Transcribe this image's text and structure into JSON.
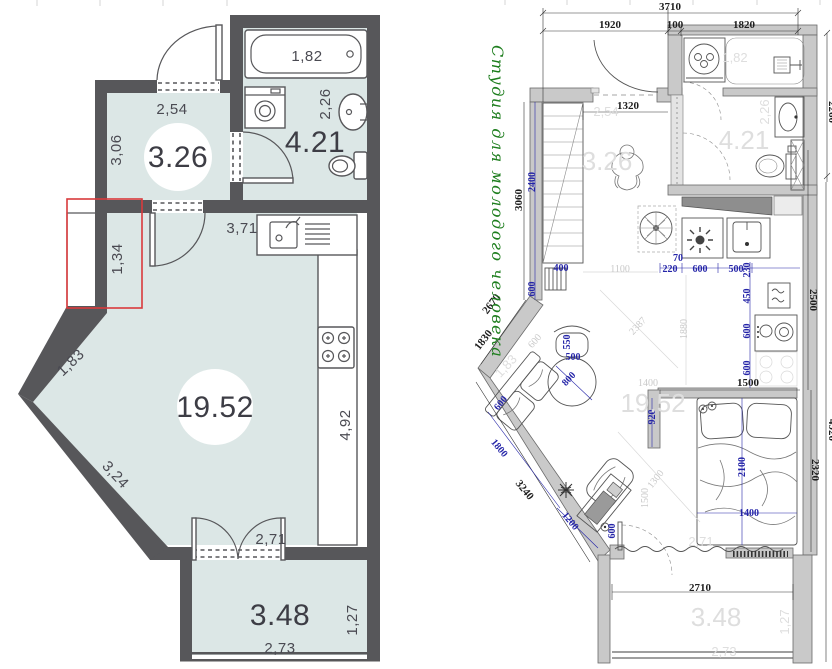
{
  "palette": {
    "wall_dark": "#57575a",
    "floor": "#dce7e6",
    "red_highlight": "#d93a3c",
    "cad_wall_gray": "#c9c9c9",
    "dim_blue": "#2525a8",
    "dim_black": "#1f1f1f",
    "faded_gray": "#d9d9d9",
    "title_green": "#1e7e1e"
  },
  "left_plan": {
    "labels": [
      {
        "t": "1,82",
        "x": 307,
        "y": 61
      },
      {
        "t": "2,26",
        "x": 330,
        "y": 104,
        "r": -90
      },
      {
        "t": "4.21",
        "x": 315,
        "y": 152,
        "c": "area"
      },
      {
        "t": "2,54",
        "x": 172,
        "y": 114
      },
      {
        "t": "3,06",
        "x": 121,
        "y": 150,
        "r": -90
      },
      {
        "t": "3.26",
        "x": 178,
        "y": 167,
        "c": "area",
        "badge": {
          "cx": 178,
          "cy": 157,
          "rad": 34
        }
      },
      {
        "t": "1,34",
        "x": 122,
        "y": 259,
        "r": -90
      },
      {
        "t": "3,71",
        "x": 242,
        "y": 233
      },
      {
        "t": "1,83",
        "x": 74,
        "y": 366,
        "r": -44
      },
      {
        "t": "19.52",
        "x": 215,
        "y": 417,
        "c": "area",
        "badge": {
          "cx": 215,
          "cy": 407,
          "rad": 38
        }
      },
      {
        "t": "4,92",
        "x": 350,
        "y": 425,
        "r": -90
      },
      {
        "t": "3,24",
        "x": 112,
        "y": 478,
        "r": 47
      },
      {
        "t": "2,71",
        "x": 271,
        "y": 544
      },
      {
        "t": "3.48",
        "x": 280,
        "y": 625,
        "c": "area"
      },
      {
        "t": "2,73",
        "x": 280,
        "y": 653
      },
      {
        "t": "1,27",
        "x": 357,
        "y": 620,
        "r": -90
      }
    ]
  },
  "right_plan": {
    "title": "Студия для молодого человека",
    "black_dims": [
      {
        "t": "3710",
        "x": 670,
        "y": 10
      },
      {
        "t": "1920",
        "x": 610,
        "y": 28
      },
      {
        "t": "100",
        "x": 675,
        "y": 28
      },
      {
        "t": "1820",
        "x": 744,
        "y": 28
      },
      {
        "t": "2260",
        "x": 829,
        "y": 112,
        "r": 90
      },
      {
        "t": "1320",
        "x": 628,
        "y": 109
      },
      {
        "t": "3060",
        "x": 522,
        "y": 200,
        "r": -90
      },
      {
        "t": "2670",
        "x": 494,
        "y": 306,
        "r": -52
      },
      {
        "t": "1830",
        "x": 486,
        "y": 342,
        "r": -52
      },
      {
        "t": "3240",
        "x": 522,
        "y": 492,
        "r": 51
      },
      {
        "t": "2500",
        "x": 810,
        "y": 300,
        "r": 90
      },
      {
        "t": "4920",
        "x": 829,
        "y": 430,
        "r": 90
      },
      {
        "t": "2320",
        "x": 812,
        "y": 470,
        "r": 90
      },
      {
        "t": "1500",
        "x": 748,
        "y": 386
      },
      {
        "t": "2710",
        "x": 700,
        "y": 591
      }
    ],
    "blue_dims": [
      {
        "t": "2400",
        "x": 535,
        "y": 182,
        "r": -90
      },
      {
        "t": "600",
        "x": 535,
        "y": 289,
        "r": -90
      },
      {
        "t": "400",
        "x": 561,
        "y": 271
      },
      {
        "t": "220",
        "x": 670,
        "y": 272
      },
      {
        "t": "70",
        "x": 678,
        "y": 261
      },
      {
        "t": "600",
        "x": 700,
        "y": 272
      },
      {
        "t": "500",
        "x": 736,
        "y": 272
      },
      {
        "t": "230",
        "x": 750,
        "y": 270,
        "r": -90
      },
      {
        "t": "450",
        "x": 750,
        "y": 296,
        "r": -90
      },
      {
        "t": "600",
        "x": 750,
        "y": 331,
        "r": -90
      },
      {
        "t": "600",
        "x": 750,
        "y": 368,
        "r": -90
      },
      {
        "t": "920",
        "x": 655,
        "y": 417,
        "r": -90
      },
      {
        "t": "2100",
        "x": 745,
        "y": 467,
        "r": -90
      },
      {
        "t": "1400",
        "x": 749,
        "y": 516
      },
      {
        "t": "550",
        "x": 570,
        "y": 342,
        "r": -90
      },
      {
        "t": "500",
        "x": 573,
        "y": 360
      },
      {
        "t": "800",
        "x": 571,
        "y": 381,
        "r": -47
      },
      {
        "t": "600",
        "x": 503,
        "y": 405,
        "r": -51
      },
      {
        "t": "1800",
        "x": 497,
        "y": 450,
        "r": 50
      },
      {
        "t": "1200",
        "x": 568,
        "y": 523,
        "r": 50
      },
      {
        "t": "600",
        "x": 615,
        "y": 531,
        "r": -90
      }
    ],
    "faded_dims": [
      {
        "t": "1100",
        "x": 620,
        "y": 272
      },
      {
        "t": "1880",
        "x": 687,
        "y": 329,
        "r": -90
      },
      {
        "t": "2387",
        "x": 640,
        "y": 328,
        "r": -47
      },
      {
        "t": "1300",
        "x": 658,
        "y": 481,
        "r": -52
      },
      {
        "t": "1500",
        "x": 648,
        "y": 498,
        "r": -90
      },
      {
        "t": "1400",
        "x": 648,
        "y": 386
      },
      {
        "t": "600",
        "x": 537,
        "y": 343,
        "r": -49
      }
    ],
    "faded_room_labels": [
      {
        "t": "2,54",
        "x": 606,
        "y": 116,
        "s": 13
      },
      {
        "t": "3.26",
        "x": 607,
        "y": 170,
        "s": 26
      },
      {
        "t": "1,82",
        "x": 735,
        "y": 62,
        "s": 13
      },
      {
        "t": "2,26",
        "x": 769,
        "y": 112,
        "r": -90,
        "s": 13
      },
      {
        "t": "4.21",
        "x": 744,
        "y": 149,
        "s": 26
      },
      {
        "t": "19.52",
        "x": 653,
        "y": 412,
        "s": 26
      },
      {
        "t": "2,71",
        "x": 701,
        "y": 546,
        "s": 13
      },
      {
        "t": "3.48",
        "x": 716,
        "y": 626,
        "s": 26
      },
      {
        "t": "2,73",
        "x": 724,
        "y": 656,
        "s": 13
      },
      {
        "t": "1,27",
        "x": 789,
        "y": 622,
        "r": -90,
        "s": 13
      },
      {
        "t": "1,83",
        "x": 509,
        "y": 369,
        "r": -47,
        "s": 13
      }
    ]
  }
}
